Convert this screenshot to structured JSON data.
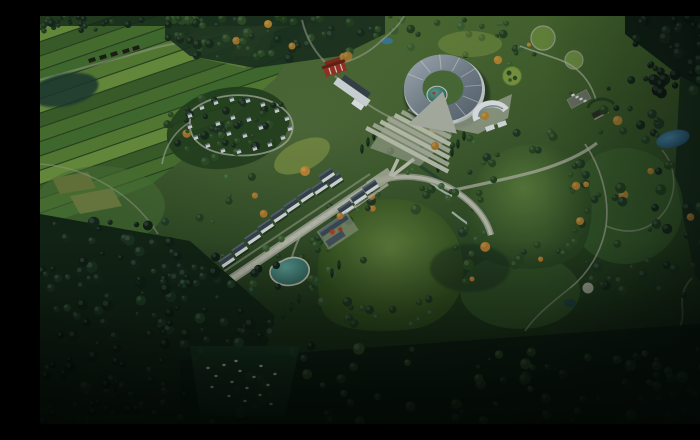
{
  "scene": {
    "label": "aerial-rendering-eco-park-masterplan"
  },
  "palette": {
    "base_top": "#48672f",
    "base_mid": "#2a4621",
    "base_bottom": "#0f2012",
    "farm_gap": "#2c4520",
    "farm_stripes": [
      "#3e612c",
      "#4c7332",
      "#447031",
      "#5a8136",
      "#6d9340"
    ],
    "farm_light": "#7d9a44",
    "farm_yellow": "#a8ae52",
    "farm_tan1": "#8f7d45",
    "farm_tan2": "#9c8950",
    "farm_tan3": "#7d6c3c",
    "forest_deep": "#122416",
    "forest_dark": "#16281a",
    "path": "#c2c4b4",
    "road_edge": "#9da092",
    "road_core": "#bcbfae",
    "plaza": "#b3b7aa",
    "water_teal_hi": "#5fa39b",
    "water_teal_lo": "#2a5a55",
    "water_blue_hi": "#4b8ab0",
    "water_blue_lo": "#1f4a66",
    "water_dark": "#1d3833",
    "wall": "#dde2e4",
    "roof_dark": "#38434f",
    "roof_lit": "#5a6775",
    "roof_a": "#aeb8c2",
    "roof_b": "#77828f",
    "roof_c": "#596470",
    "red_wall": "#9e3326",
    "red_roof": "#6b1f16",
    "red_tree": "#b04028",
    "stair_a": "#c6c9b8",
    "stair_b": "#aeb2a1",
    "bird": "#f2f5ec",
    "hill_hi": "#627f3d",
    "hill_mid": "#33511f",
    "hill_lo": "#27411d",
    "hill2_hi": "#5a7c3c",
    "hill2_lo": "#2c4823",
    "autumn": "#b07a2e"
  },
  "village": {
    "rotation": -34,
    "houses": [
      [
        296,
        166
      ],
      [
        281,
        173
      ],
      [
        267,
        181
      ],
      [
        253,
        191
      ],
      [
        240,
        201
      ],
      [
        227,
        212
      ],
      [
        214,
        223
      ],
      [
        201,
        235
      ],
      [
        188,
        246
      ],
      [
        174,
        258
      ],
      [
        161,
        270
      ],
      [
        148,
        281
      ],
      [
        320,
        183
      ],
      [
        307,
        194
      ],
      [
        332,
        173
      ],
      [
        288,
        161
      ]
    ]
  },
  "camp": {
    "rotation": -20,
    "cabins": [
      [
        150,
        100
      ],
      [
        162,
        92
      ],
      [
        176,
        87
      ],
      [
        192,
        84
      ],
      [
        208,
        85
      ],
      [
        223,
        89
      ],
      [
        237,
        95
      ],
      [
        247,
        103
      ],
      [
        250,
        113
      ],
      [
        243,
        122
      ],
      [
        230,
        129
      ],
      [
        215,
        133
      ],
      [
        199,
        136
      ],
      [
        183,
        135
      ],
      [
        168,
        130
      ],
      [
        156,
        122
      ],
      [
        150,
        111
      ],
      [
        178,
        108
      ],
      [
        193,
        102
      ],
      [
        209,
        104
      ],
      [
        221,
        112
      ],
      [
        205,
        120
      ],
      [
        189,
        118
      ]
    ]
  },
  "parking": {
    "rotation": -28,
    "cars": [
      {
        "x": 533,
        "y": 79,
        "c": "#eef0ea"
      },
      {
        "x": 537,
        "y": 81,
        "c": "#e6e9e4"
      },
      {
        "x": 541,
        "y": 83,
        "c": "#eef0ea"
      },
      {
        "x": 545,
        "y": 85,
        "c": "#dfe3de"
      },
      {
        "x": 531,
        "y": 77,
        "c": "#3a3f3a"
      }
    ]
  },
  "birds": [
    [
      168,
      352
    ],
    [
      176,
      360
    ],
    [
      184,
      349
    ],
    [
      192,
      366
    ],
    [
      200,
      355
    ],
    [
      207,
      372
    ],
    [
      214,
      361
    ],
    [
      221,
      350
    ],
    [
      228,
      369
    ],
    [
      235,
      358
    ],
    [
      189,
      380
    ],
    [
      205,
      385
    ],
    [
      220,
      379
    ],
    [
      172,
      371
    ],
    [
      231,
      388
    ],
    [
      196,
      345
    ]
  ],
  "cypress": [
    [
      322,
      133
    ],
    [
      328,
      126
    ],
    [
      334,
      120
    ],
    [
      243,
      299
    ],
    [
      251,
      291
    ],
    [
      259,
      283
    ],
    [
      292,
      257
    ],
    [
      299,
      249
    ],
    [
      424,
      120
    ],
    [
      418,
      128
    ],
    [
      412,
      136
    ],
    [
      405,
      144
    ],
    [
      398,
      152
    ]
  ],
  "accent_trees": [
    {
      "x": 265,
      "y": 155,
      "r": 5,
      "c": "#c08a35"
    },
    {
      "x": 395,
      "y": 130,
      "r": 4,
      "c": "#a97a2e"
    },
    {
      "x": 445,
      "y": 100,
      "r": 4,
      "c": "#b8862f"
    },
    {
      "x": 540,
      "y": 205,
      "r": 4,
      "c": "#a97a2e"
    },
    {
      "x": 300,
      "y": 200,
      "r": 3.5,
      "c": "#b07a2e"
    },
    {
      "x": 228,
      "y": 8,
      "r": 4,
      "c": "#b8862f"
    },
    {
      "x": 252,
      "y": 30,
      "r": 3.5,
      "c": "#a97a2e"
    }
  ],
  "forest_regions": [
    {
      "g": "forest-top",
      "kind": "rect",
      "x": 128,
      "y": 0,
      "w": 215,
      "h": 44,
      "n": 62,
      "rmin": 2,
      "rmax": 5,
      "seed": 11,
      "colors": [
        "#1d3320",
        "#24401f",
        "#2e4d26",
        "#182c1b"
      ],
      "accent": "#a97a2e",
      "ap": 0.06
    },
    {
      "g": "forest-top",
      "kind": "rect",
      "x": 0,
      "y": 0,
      "w": 135,
      "h": 16,
      "n": 26,
      "rmin": 2,
      "rmax": 4,
      "seed": 12,
      "colors": [
        "#16281a",
        "#1d3320",
        "#24401f"
      ],
      "accent": "#a97a2e",
      "ap": 0.02
    },
    {
      "g": "forest-top",
      "kind": "rect",
      "x": 345,
      "y": 0,
      "w": 150,
      "h": 50,
      "n": 26,
      "rmin": 2,
      "rmax": 4.5,
      "seed": 13,
      "colors": [
        "#24401f",
        "#2e4d26",
        "#3c6030"
      ],
      "accent": "#b8862f",
      "ap": 0.1
    },
    {
      "g": "camp-trees",
      "kind": "ring",
      "cx": 188,
      "cy": 112,
      "r0": 0,
      "r1": 42,
      "sx": 1.6,
      "sy": 1,
      "n": 55,
      "rmin": 2,
      "rmax": 4.5,
      "seed": 21,
      "colors": [
        "#1d3320",
        "#24401f",
        "#2e4d26",
        "#16281a"
      ],
      "accent": "#a97a2e",
      "ap": 0.04
    },
    {
      "g": "forest-left",
      "kind": "rect",
      "x": 0,
      "y": 205,
      "w": 150,
      "h": 95,
      "n": 52,
      "rmin": 2.5,
      "rmax": 6,
      "seed": 31,
      "colors": [
        "#14261a",
        "#1a3020",
        "#0f1f14"
      ],
      "accent": "#1f3d24",
      "ap": 0.1
    },
    {
      "g": "forest-left",
      "kind": "rect",
      "x": 120,
      "y": 240,
      "w": 120,
      "h": 105,
      "n": 46,
      "rmin": 2.5,
      "rmax": 6,
      "seed": 32,
      "colors": [
        "#14261a",
        "#1a3020",
        "#0f1f14"
      ],
      "accent": "#1f3d24",
      "ap": 0.1
    },
    {
      "g": "forest-left",
      "kind": "rect",
      "x": 0,
      "y": 290,
      "w": 130,
      "h": 118,
      "n": 55,
      "rmin": 2.5,
      "rmax": 6,
      "seed": 33,
      "colors": [
        "#101f14",
        "#16281a",
        "#0c1a10"
      ],
      "accent": "#1a3020",
      "ap": 0.1
    },
    {
      "g": "forest-bottom",
      "kind": "rect",
      "x": 140,
      "y": 330,
      "w": 560,
      "h": 78,
      "n": 88,
      "rmin": 2.5,
      "rmax": 6,
      "seed": 41,
      "colors": [
        "#15291a",
        "#1d3a22",
        "#0e1d12",
        "#2b4a28"
      ],
      "accent": "#24401f",
      "ap": 0.1
    },
    {
      "g": "hill-trees",
      "kind": "ring",
      "cx": 350,
      "cy": 242,
      "r0": 50,
      "r1": 72,
      "sx": 1.25,
      "sy": 1,
      "n": 48,
      "rmin": 2.5,
      "rmax": 5.5,
      "seed": 51,
      "colors": [
        "#1f3822",
        "#27451f",
        "#2e4d26"
      ],
      "accent": "#b07a2e",
      "ap": 0.07
    },
    {
      "g": "hill-trees",
      "kind": "ring",
      "cx": 487,
      "cy": 182,
      "r0": 42,
      "r1": 62,
      "sx": 1.1,
      "sy": 1.15,
      "n": 42,
      "rmin": 2.5,
      "rmax": 5,
      "seed": 52,
      "colors": [
        "#1f3822",
        "#27451f",
        "#2e4d26"
      ],
      "accent": "#b07a2e",
      "ap": 0.07
    },
    {
      "g": "forest-right",
      "kind": "rect",
      "x": 545,
      "y": 50,
      "w": 150,
      "h": 230,
      "n": 72,
      "rmin": 2,
      "rmax": 5.5,
      "seed": 61,
      "colors": [
        "#16281a",
        "#1f3822",
        "#24401f"
      ],
      "accent": "#a97a2e",
      "ap": 0.04
    },
    {
      "g": "forest-tr",
      "kind": "rect",
      "x": 595,
      "y": 0,
      "w": 105,
      "h": 78,
      "n": 46,
      "rmin": 2.5,
      "rmax": 6,
      "seed": 62,
      "colors": [
        "#101f15",
        "#16281a",
        "#0c1a10"
      ],
      "accent": "#1a3020",
      "ap": 0.1
    },
    {
      "g": "scatter-mid",
      "kind": "rect",
      "x": 350,
      "y": 115,
      "w": 110,
      "h": 70,
      "n": 22,
      "rmin": 2,
      "rmax": 4.5,
      "seed": 71,
      "colors": [
        "#2e4d26",
        "#3c6030",
        "#24401f"
      ],
      "accent": "#b8862f",
      "ap": 0.12
    },
    {
      "g": "scatter-mid",
      "kind": "rect",
      "x": 150,
      "y": 160,
      "w": 190,
      "h": 130,
      "n": 24,
      "rmin": 2,
      "rmax": 4,
      "seed": 72,
      "colors": [
        "#2e4d26",
        "#3c6030",
        "#24401f"
      ],
      "accent": "#b07a2e",
      "ap": 0.06
    }
  ]
}
